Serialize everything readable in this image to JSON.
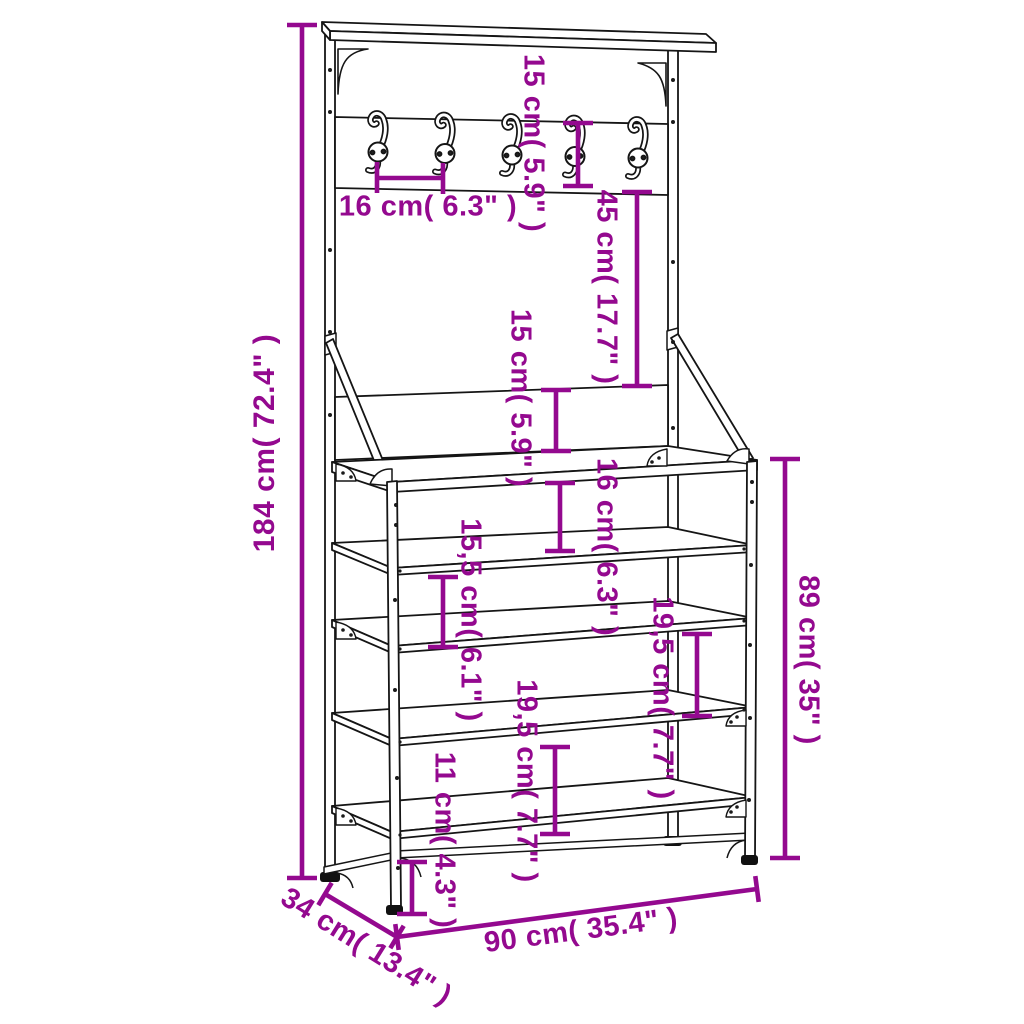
{
  "diagram": {
    "type": "product-dimension-diagram",
    "product": "clothes rack with coat hooks, bench and 4 shoe shelves",
    "hook_count": 5,
    "shelf_count": 4,
    "colors": {
      "accent": "#94098f",
      "line": "#151515",
      "background": "#ffffff"
    },
    "dimensions": [
      {
        "id": "total-height",
        "label": "184 cm( 72.4\" )",
        "cm": 184,
        "inch": 72.4,
        "orientation": "vertical"
      },
      {
        "id": "hook-rail-height",
        "label": "15 cm( 5.9\" )",
        "cm": 15,
        "inch": 5.9,
        "orientation": "vertical"
      },
      {
        "id": "hook-spacing",
        "label": "16 cm( 6.3\" )",
        "cm": 16,
        "inch": 6.3,
        "orientation": "horizontal"
      },
      {
        "id": "rail-to-panel-gap",
        "label": "45 cm( 17.7\" )",
        "cm": 45,
        "inch": 17.7,
        "orientation": "vertical"
      },
      {
        "id": "lower-panel-height",
        "label": "15 cm( 5.9\" )",
        "cm": 15,
        "inch": 5.9,
        "orientation": "vertical"
      },
      {
        "id": "bench-to-first-shelf",
        "label": "16 cm( 6.3\" )",
        "cm": 16,
        "inch": 6.3,
        "orientation": "vertical"
      },
      {
        "id": "upper-shelf-gap",
        "label": "15,5 cm( 6.1\" )",
        "cm": 15.5,
        "inch": 6.1,
        "orientation": "vertical"
      },
      {
        "id": "right-shelf-gap",
        "label": "19,5 cm( 7.7\" )",
        "cm": 19.5,
        "inch": 7.7,
        "orientation": "vertical"
      },
      {
        "id": "lower-shelf-gap",
        "label": "19,5 cm( 7.7\" )",
        "cm": 19.5,
        "inch": 7.7,
        "orientation": "vertical"
      },
      {
        "id": "floor-clearance",
        "label": "11 cm( 4.3\" )",
        "cm": 11,
        "inch": 4.3,
        "orientation": "vertical"
      },
      {
        "id": "bench-height",
        "label": "89 cm( 35\" )",
        "cm": 89,
        "inch": 35,
        "orientation": "vertical"
      },
      {
        "id": "width",
        "label": "90 cm( 35.4\" )",
        "cm": 90,
        "inch": 35.4,
        "orientation": "horizontal"
      },
      {
        "id": "depth",
        "label": "34 cm( 13.4\" )",
        "cm": 34,
        "inch": 13.4,
        "orientation": "diagonal"
      }
    ]
  }
}
